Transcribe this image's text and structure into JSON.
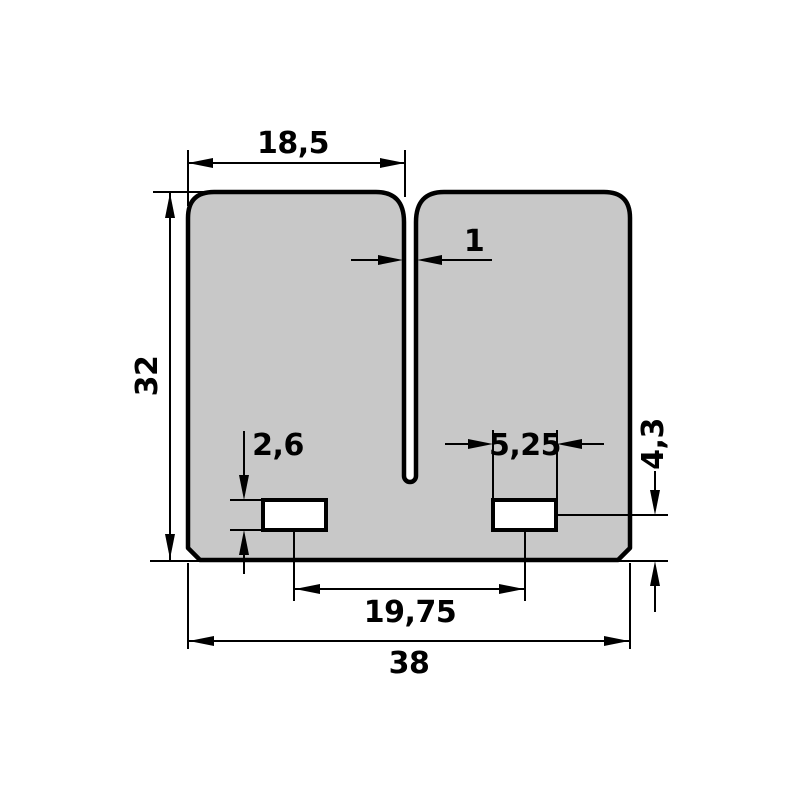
{
  "drawing": {
    "kind": "2D technical dimension drawing",
    "subject": "dual-petal reed valve plate with central slot and two rectangular windows",
    "background": "#ffffff",
    "part_fill": "#c8c8c8",
    "line_color": "#000000",
    "dimensions": {
      "petal_width": "18,5",
      "slot_width": "1",
      "overall_height": "32",
      "window_height": "2,6",
      "window_width": "5,25",
      "window_center_to_bottom": "4,3",
      "window_spacing": "19,75",
      "overall_width": "38"
    }
  }
}
